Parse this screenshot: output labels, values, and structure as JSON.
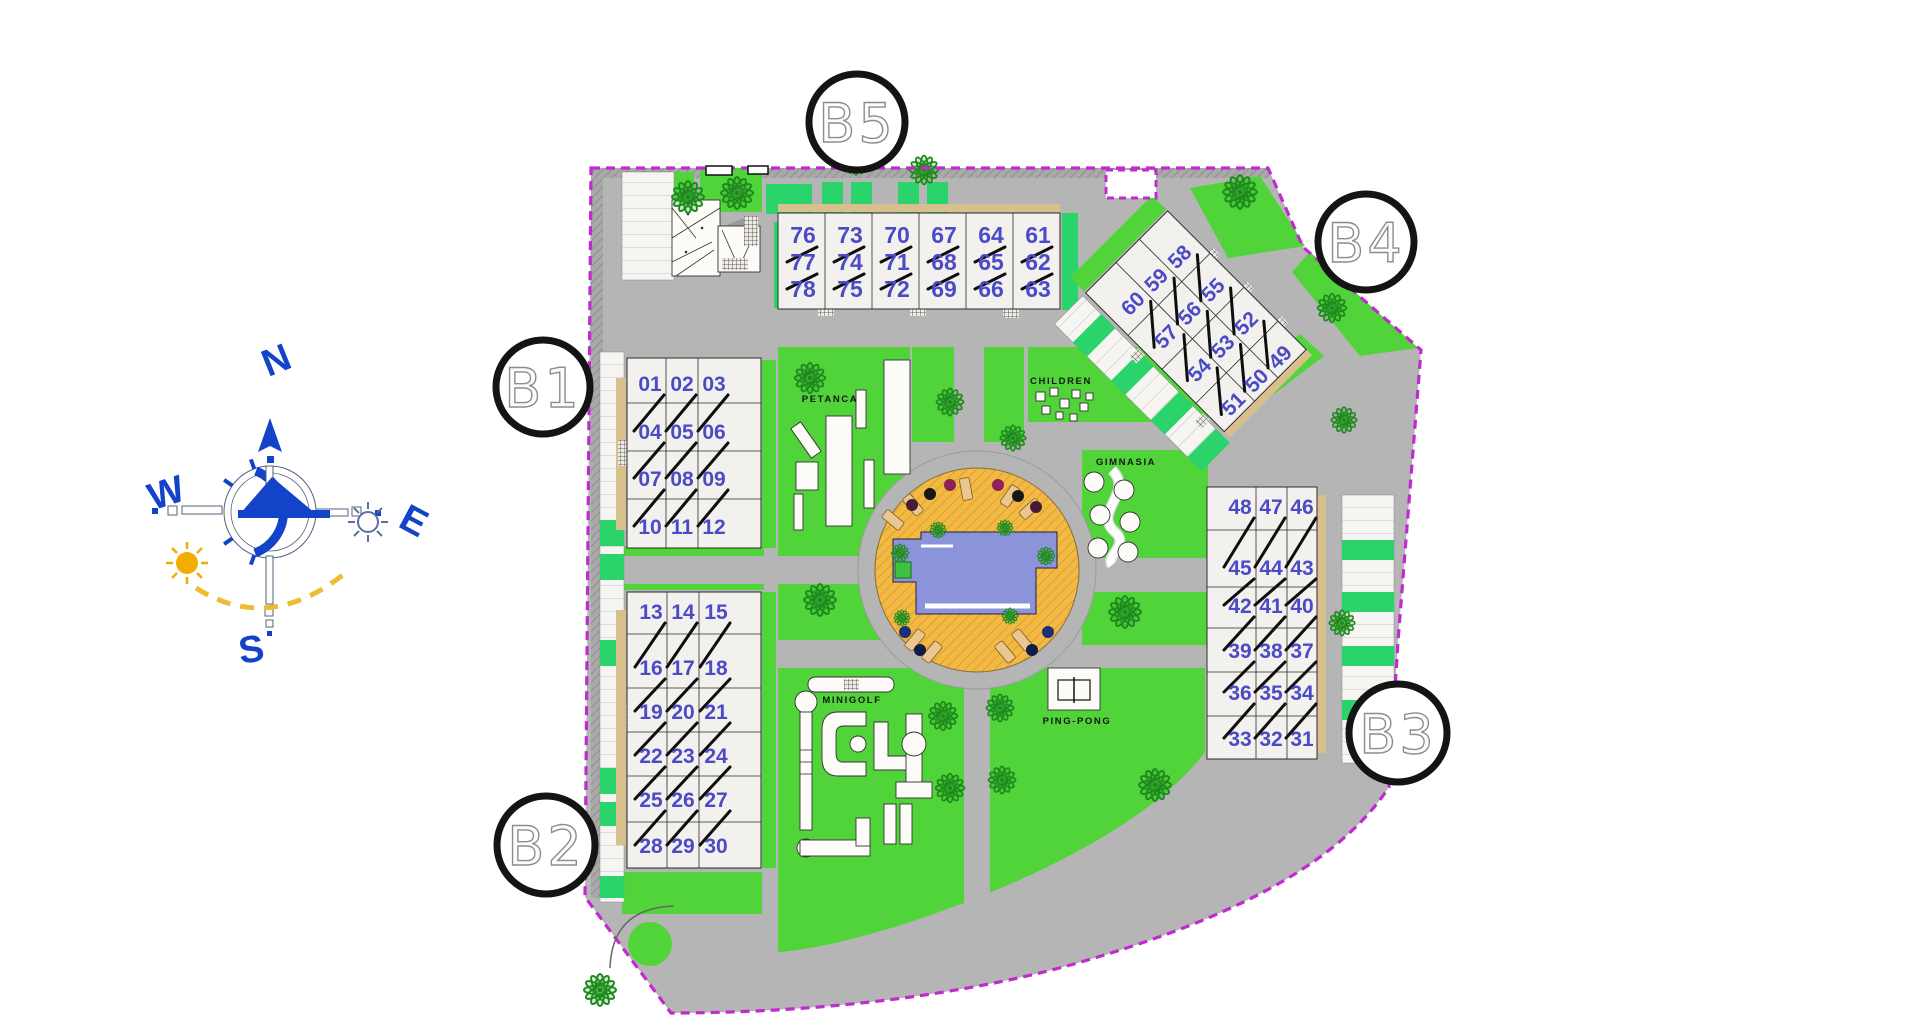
{
  "compass": {
    "north": "N",
    "south": "S",
    "east": "E",
    "west": "W"
  },
  "blocks": [
    {
      "label": "B1"
    },
    {
      "label": "B2"
    },
    {
      "label": "B3"
    },
    {
      "label": "B4"
    },
    {
      "label": "B5"
    }
  ],
  "amenities": {
    "petanca": "PETANCA",
    "children": "CHILDREN",
    "gym": "GIMNASIA",
    "minigolf": "MINIGOLF",
    "pingpong": "PING-PONG"
  },
  "buildings": [
    {
      "id": "B5",
      "rows": [
        [
          "76",
          "73",
          "70",
          "67",
          "64",
          "61"
        ],
        [
          "77",
          "74",
          "71",
          "68",
          "65",
          "62"
        ],
        [
          "78",
          "75",
          "72",
          "69",
          "66",
          "63"
        ]
      ]
    },
    {
      "id": "B1",
      "rows": [
        [
          "01",
          "02",
          "03"
        ],
        [
          "04",
          "05",
          "06"
        ],
        [
          "07",
          "08",
          "09"
        ],
        [
          "10",
          "11",
          "12"
        ]
      ]
    },
    {
      "id": "B2",
      "rows": [
        [
          "13",
          "14",
          "15"
        ],
        [
          "16",
          "17",
          "18"
        ],
        [
          "19",
          "20",
          "21"
        ],
        [
          "22",
          "23",
          "24"
        ],
        [
          "25",
          "26",
          "27"
        ],
        [
          "28",
          "29",
          "30"
        ]
      ]
    },
    {
      "id": "B3",
      "rows": [
        [
          "48",
          "47",
          "46"
        ],
        [
          "45",
          "44",
          "43"
        ],
        [
          "42",
          "41",
          "40"
        ],
        [
          "39",
          "38",
          "37"
        ],
        [
          "36",
          "35",
          "34"
        ],
        [
          "33",
          "32",
          "31"
        ]
      ]
    },
    {
      "id": "B4",
      "rows": [
        [
          "60",
          "59",
          "58"
        ],
        [
          "57",
          "56",
          "55"
        ],
        [
          "54",
          "53",
          "52"
        ],
        [
          "51",
          "50",
          "49"
        ]
      ]
    }
  ],
  "colors": {
    "lawn": "#50d43a",
    "hedge": "#2bd46a",
    "road": "#b5b5b5",
    "building_fill": "#f3f1ed",
    "unit_number": "#4b4bc7",
    "pool_water": "#8b93da",
    "pool_deck": "#f2b944",
    "boundary": "#c22ad1",
    "tree": "#1e8a1e",
    "compass_blue": "#1243c8",
    "sun": "#f2ae00"
  }
}
